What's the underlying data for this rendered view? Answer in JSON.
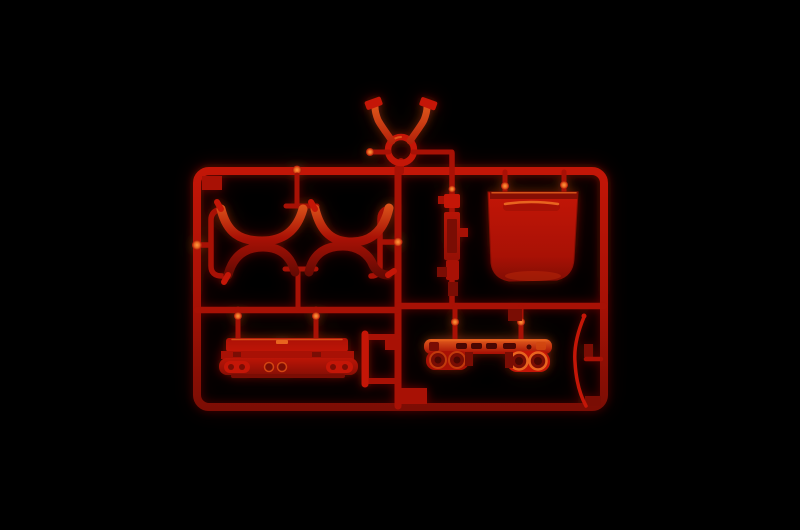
{
  "scene": {
    "type": "photograph",
    "subject": "Injection-molded plastic model kit sprue (runner frame) with parts attached",
    "plastic_color_name": "red",
    "background": "solid black"
  },
  "colors": {
    "bg": "#000000",
    "red_base": "#a81105",
    "red_bright": "#c41607",
    "red_dark": "#7a0d04",
    "red_deep": "#4a0702",
    "orange_highlight": "#e8641f",
    "hot_highlight": "#ff9a40"
  },
  "parts": [
    {
      "id": "runner-frame",
      "description": "Rectangular runner frame with rounded corners and small corner gussets"
    },
    {
      "id": "pivot-fork",
      "description": "Y-shaped fork with ring hub attached above the top rail"
    },
    {
      "id": "arch-top-left",
      "description": "Downward-bowed arch segment, upper-left group"
    },
    {
      "id": "arch-top-right",
      "description": "Downward-bowed arch segment, upper-right of group"
    },
    {
      "id": "arch-bottom-left",
      "description": "Upward-bowed arch segment, lower-left of group"
    },
    {
      "id": "arch-bottom-right",
      "description": "Upward-bowed arch segment with flared tail, lower-right of group"
    },
    {
      "id": "hull-base",
      "description": "Stepped hull base block with twin round bosses and rounded end pods"
    },
    {
      "id": "open-bracket",
      "description": "Open rectangular bracket attached to the central runner"
    },
    {
      "id": "ribbed-strip",
      "description": "Slender ribbed strip with side tabs on the right vertical runner"
    },
    {
      "id": "bucket-panel",
      "description": "Deep rounded pan with handle slot hung from the top rail"
    },
    {
      "id": "lightbar-beam",
      "description": "Slotted beam with twin round drums at each end"
    },
    {
      "id": "bowed-blade",
      "description": "Thin bowed blade attached to the right rail"
    }
  ]
}
